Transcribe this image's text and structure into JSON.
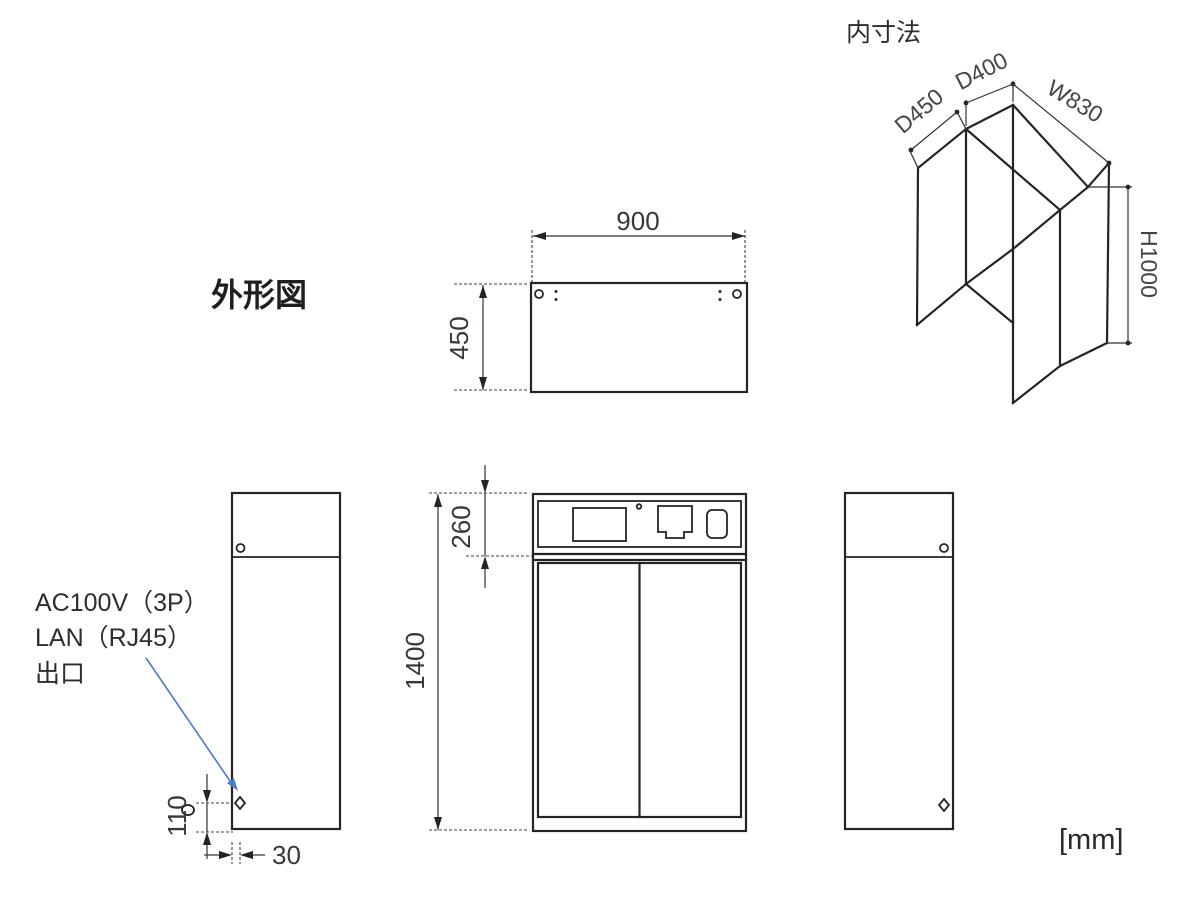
{
  "drawing": {
    "outline_title": "外形図",
    "inner_title": "内寸法",
    "unit": "[mm]",
    "dimensions": {
      "top_width": "900",
      "top_depth": "450",
      "front_panel_height": "260",
      "front_total_height": "1400",
      "outlet_height": "110",
      "outlet_offset": "30",
      "inner_depth_lower": "D450",
      "inner_depth_upper": "D400",
      "inner_width": "W830",
      "inner_height": "H1000"
    },
    "callout": {
      "line1": "AC100V（3P）",
      "line2": "LAN（RJ45）",
      "line3": "出口"
    },
    "colors": {
      "line": "#262321",
      "text": "#3c3733",
      "leader": "#4d7cc7"
    }
  }
}
